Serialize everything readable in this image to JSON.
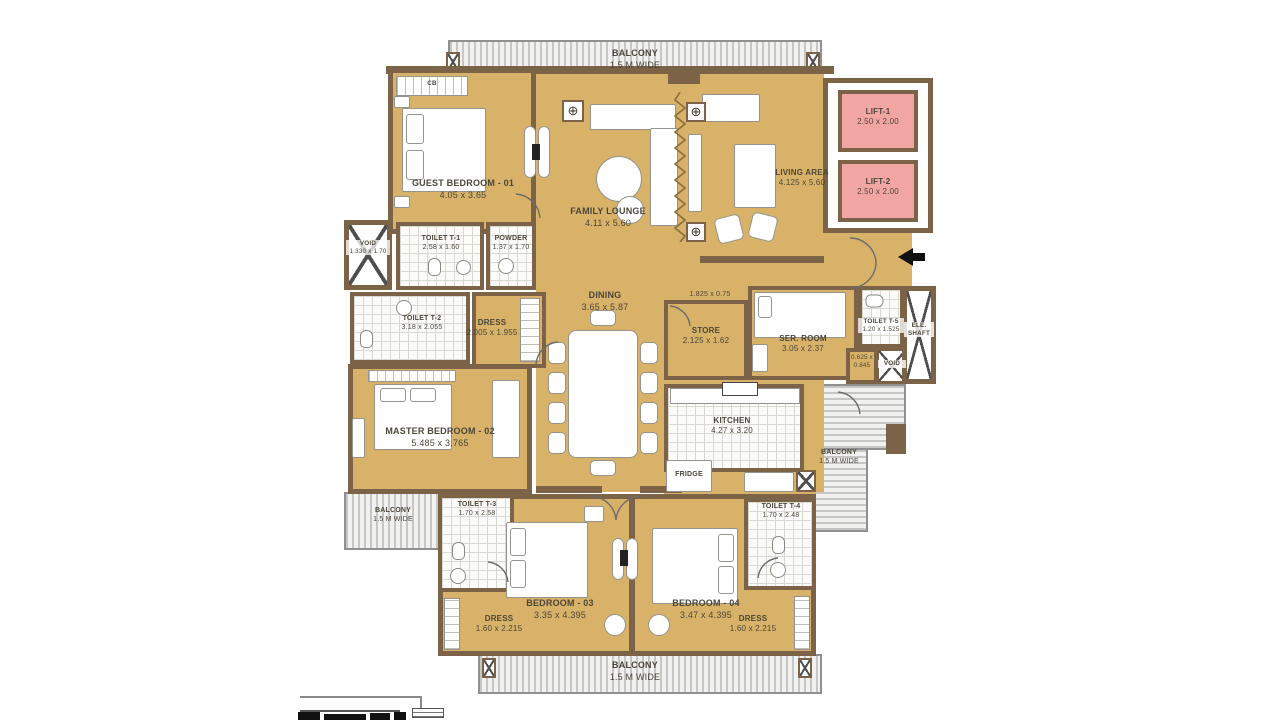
{
  "palette": {
    "floor_tan": "#d8b268",
    "wall_brown": "#7c6347",
    "lift_pink": "#f2a6a3",
    "tile_white": "#fbfbfa",
    "balcony_gray": "#f1f1ef",
    "text": "#4b463a"
  },
  "rooms": {
    "guest_bedroom": {
      "name": "GUEST BEDROOM - 01",
      "dims": "4.05 x 3.65"
    },
    "family_lounge": {
      "name": "FAMILY LOUNGE",
      "dims": "4.11 x 5.60"
    },
    "living_area": {
      "name": "LIVING AREA",
      "dims": "4.125 x 5.60"
    },
    "lift_1": {
      "name": "LIFT-1",
      "dims": "2.50 x 2.00"
    },
    "lift_2": {
      "name": "LIFT-2",
      "dims": "2.50 x 2.00"
    },
    "void_left": {
      "name": "VOID",
      "dims": "1.330 x 1.70"
    },
    "toilet_t1": {
      "name": "TOILET T-1",
      "dims": "2.58 x 1.60"
    },
    "powder": {
      "name": "POWDER",
      "dims": "1.37 x 1.70"
    },
    "toilet_t2": {
      "name": "TOILET T-2",
      "dims": "3.18 x 2.055"
    },
    "dress_master": {
      "name": "DRESS",
      "dims": "2.005 x 1.955"
    },
    "dining": {
      "name": "DINING",
      "dims": "3.65 x 5.87"
    },
    "passage": {
      "dims": "1.825 x 0.75"
    },
    "store": {
      "name": "STORE",
      "dims": "2.125 x 1.62"
    },
    "ser_room": {
      "name": "SER. ROOM",
      "dims": "3.05 x 2.37"
    },
    "toilet_t5": {
      "name": "TOILET T-5",
      "dims": "1.20 x 1.525"
    },
    "shaft_small": {
      "dims": "0.625 x 0.845"
    },
    "void_right": {
      "name": "VOID"
    },
    "ele_shaft": {
      "name": "ELE. SHAFT"
    },
    "master_bedroom": {
      "name": "MASTER BEDROOM - 02",
      "dims": "5.485 x 3.765"
    },
    "kitchen": {
      "name": "KITCHEN",
      "dims": "4.27 x 3.20"
    },
    "fridge": {
      "name": "FRIDGE"
    },
    "toilet_t3": {
      "name": "TOILET T-3",
      "dims": "1.70 x 2.58"
    },
    "toilet_t4": {
      "name": "TOILET T-4",
      "dims": "1.70 x 2.48"
    },
    "bedroom_03": {
      "name": "BEDROOM - 03",
      "dims": "3.35 x 4.395"
    },
    "bedroom_04": {
      "name": "BEDROOM - 04",
      "dims": "3.47 x 4.395"
    },
    "dress_03": {
      "name": "DRESS",
      "dims": "1.60 x 2.215"
    },
    "dress_04": {
      "name": "DRESS",
      "dims": "1.60 x 2.215"
    },
    "closet_cb": {
      "name": "CB"
    }
  },
  "balconies": {
    "top": {
      "name": "BALCONY",
      "dims": "1.5 M WIDE"
    },
    "left": {
      "name": "BALCONY",
      "dims": "1.5 M WIDE"
    },
    "right": {
      "name": "BALCONY",
      "dims": "1.5 M WIDE"
    },
    "bottom": {
      "name": "BALCONY",
      "dims": "1.5 M WIDE"
    }
  }
}
